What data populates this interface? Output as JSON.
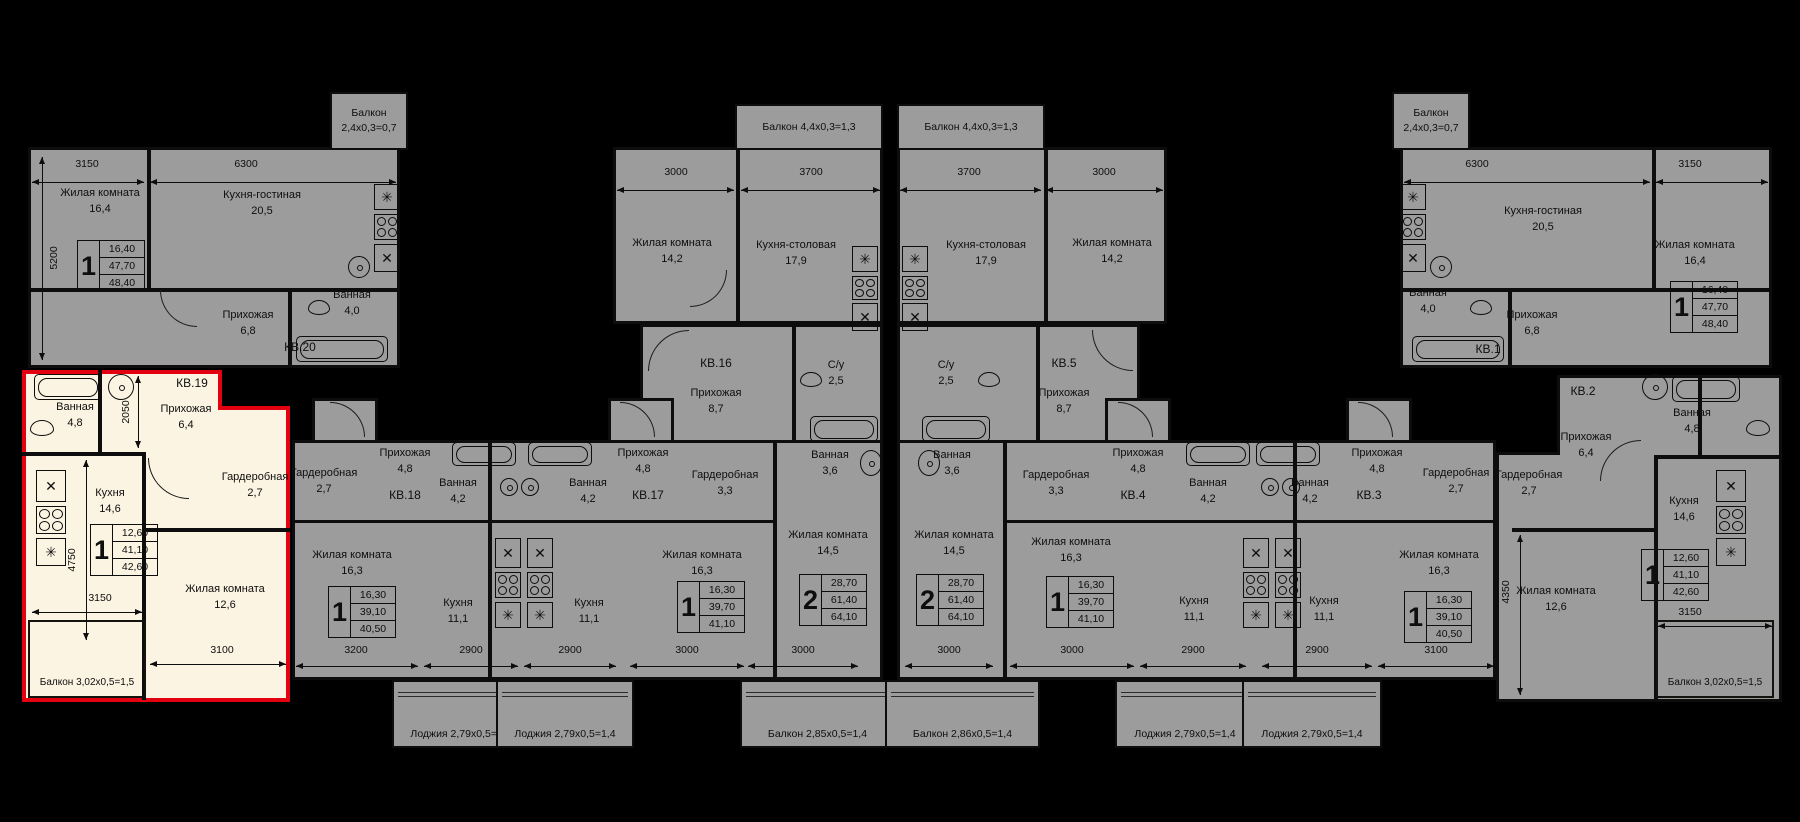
{
  "colors": {
    "background": "#000000",
    "unit_fill": "#9c9c9c",
    "walls": "#0d0d0d",
    "highlight_fill": "#fcf4e2",
    "highlight_border": "#e30010"
  },
  "icons": {
    "stove_cross": "✕",
    "asterisk": "✳"
  },
  "units": {
    "kv20": {
      "id": "КВ.20",
      "type": "1",
      "s1": "16,40",
      "s2": "47,70",
      "s3": "48,40",
      "living": "Жилая комната",
      "living_a": "16,4",
      "kitchen": "Кухня-гостиная",
      "kitchen_a": "20,5",
      "hall": "Прихожая",
      "hall_a": "6,8",
      "bath": "Ванная",
      "bath_a": "4,0",
      "balc1": "Балкон",
      "balc2": "2,4х0,3=0,7",
      "dim_w1": "3150",
      "dim_w2": "6300",
      "dim_h": "5200"
    },
    "kv19": {
      "id": "КВ.19",
      "type": "1",
      "s1": "12,60",
      "s2": "41,10",
      "s3": "42,60",
      "bath": "Ванная",
      "bath_a": "4,8",
      "hall": "Прихожая",
      "hall_a": "6,4",
      "kitchen": "Кухня",
      "kitchen_a": "14,6",
      "ward": "Гардеробная",
      "ward_a": "2,7",
      "living": "Жилая комната",
      "living_a": "12,6",
      "balc": "Балкон 3,02х0,5=1,5",
      "d2050": "2050",
      "d4750": "4750",
      "d3150": "3150",
      "d3100": "3100"
    },
    "kv18": {
      "id": "КВ.18",
      "type": "1",
      "s1": "16,30",
      "s2": "39,10",
      "s3": "40,50",
      "ward": "Гардеробная",
      "ward_a": "2,7",
      "hall": "Прихожая",
      "hall_a": "4,8",
      "bath": "Ванная",
      "bath_a": "4,2",
      "living": "Жилая комната",
      "living_a": "16,3",
      "kitchen": "Кухня",
      "kitchen_a": "11,1",
      "loggia": "Лоджия 2,79х0,5=1,4",
      "dim_w1": "3200",
      "dim_w2": "2900"
    },
    "kv17": {
      "id": "КВ.17",
      "type": "1",
      "s1": "16,30",
      "s2": "39,70",
      "s3": "41,10",
      "hall": "Прихожая",
      "hall_a": "4,8",
      "bath": "Ванная",
      "bath_a": "4,2",
      "ward": "Гардеробная",
      "ward_a": "3,3",
      "living": "Жилая комната",
      "living_a": "16,3",
      "kitchen": "Кухня",
      "kitchen_a": "11,1",
      "loggia": "Лоджия 2,79х0,5=1,4",
      "dim_w1": "2900",
      "dim_w2": "3000"
    },
    "kv16": {
      "id": "КВ.16",
      "type": "2",
      "s1": "28,70",
      "s2": "61,40",
      "s3": "64,10",
      "living1": "Жилая комната",
      "living1_a": "14,2",
      "kitchen": "Кухня-столовая",
      "kitchen_a": "17,9",
      "wc": "С/у",
      "wc_a": "2,5",
      "hall": "Прихожая",
      "hall_a": "8,7",
      "bath": "Ванная",
      "bath_a": "3,6",
      "living2": "Жилая комната",
      "living2_a": "14,5",
      "balc_top": "Балкон 4,4х0,3=1,3",
      "balc_bot": "Балкон 2,85х0,5=1,4",
      "dim_w1": "3000",
      "dim_w2": "3700",
      "dim_b": "3000"
    },
    "kv5": {
      "id": "КВ.5",
      "type": "2",
      "s1": "28,70",
      "s2": "61,40",
      "s3": "64,10",
      "living1": "Жилая комната",
      "living1_a": "14,2",
      "kitchen": "Кухня-столовая",
      "kitchen_a": "17,9",
      "wc": "С/у",
      "wc_a": "2,5",
      "hall": "Прихожая",
      "hall_a": "8,7",
      "bath": "Ванная",
      "bath_a": "3,6",
      "living2": "Жилая комната",
      "living2_a": "14,5",
      "balc_top": "Балкон 4,4х0,3=1,3",
      "balc_bot": "Балкон 2,86х0,5=1,4",
      "dim_w1": "3700",
      "dim_w2": "3000",
      "dim_b": "3000"
    },
    "kv4": {
      "id": "КВ.4",
      "type": "1",
      "s1": "16,30",
      "s2": "39,70",
      "s3": "41,10",
      "hall": "Прихожая",
      "hall_a": "4,8",
      "bath": "Ванная",
      "bath_a": "4,2",
      "ward": "Гардеробная",
      "ward_a": "3,3",
      "living": "Жилая комната",
      "living_a": "16,3",
      "kitchen": "Кухня",
      "kitchen_a": "11,1",
      "loggia": "Лоджия 2,79х0,5=1,4",
      "dim_w1": "3000",
      "dim_w2": "2900"
    },
    "kv3": {
      "id": "КВ.3",
      "type": "1",
      "s1": "16,30",
      "s2": "39,10",
      "s3": "40,50",
      "hall": "Прихожая",
      "hall_a": "4,8",
      "bath": "Ванная",
      "bath_a": "4,2",
      "ward": "Гардеробная",
      "ward_a": "2,7",
      "living": "Жилая комната",
      "living_a": "16,3",
      "kitchen": "Кухня",
      "kitchen_a": "11,1",
      "loggia": "Лоджия 2,79х0,5=1,4",
      "dim_w1": "2900",
      "dim_w2": "3100"
    },
    "kv2": {
      "id": "КВ.2",
      "type": "1",
      "s1": "12,60",
      "s2": "41,10",
      "s3": "42,60",
      "bath": "Ванная",
      "bath_a": "4,8",
      "hall": "Прихожая",
      "hall_a": "6,4",
      "kitchen": "Кухня",
      "kitchen_a": "14,6",
      "ward": "Гардеробная",
      "ward_a": "2,7",
      "living": "Жилая комната",
      "living_a": "12,6",
      "balc": "Балкон 3,02х0,5=1,5",
      "d4350": "4350",
      "d3150": "3150"
    },
    "kv1": {
      "id": "КВ.1",
      "type": "1",
      "s1": "16,40",
      "s2": "47,70",
      "s3": "48,40",
      "living": "Жилая комната",
      "living_a": "16,4",
      "kitchen": "Кухня-гостиная",
      "kitchen_a": "20,5",
      "hall": "Прихожая",
      "hall_a": "6,8",
      "bath": "Ванная",
      "bath_a": "4,0",
      "balc1": "Балкон",
      "balc2": "2,4х0,3=0,7",
      "dim_w1": "6300",
      "dim_w2": "3150"
    }
  }
}
